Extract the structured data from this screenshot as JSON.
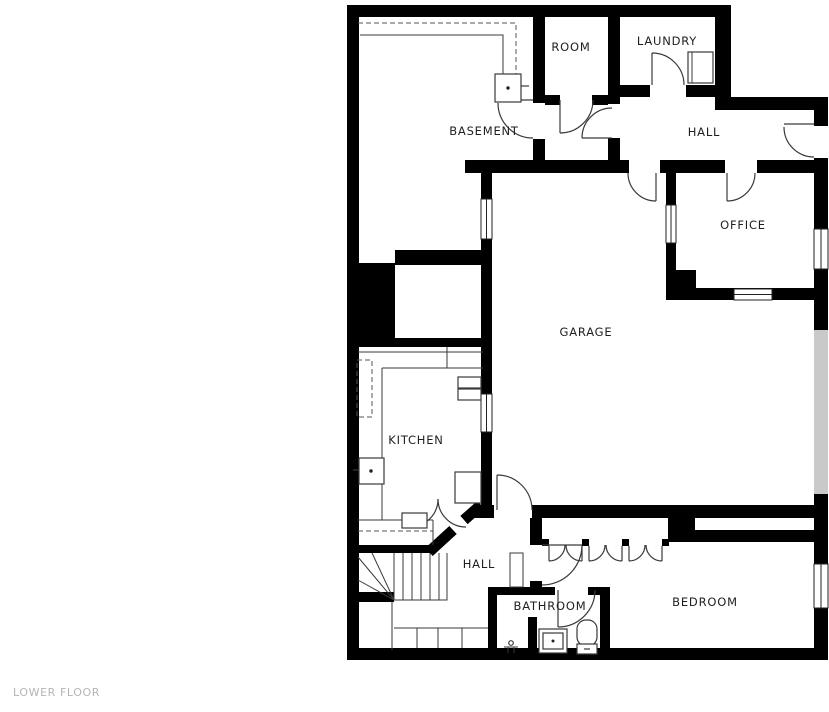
{
  "plan": {
    "floor_label": "LOWER FLOOR",
    "rooms": [
      {
        "id": "basement",
        "label": "BASEMENT",
        "x": 484,
        "y": 135
      },
      {
        "id": "room",
        "label": "ROOM",
        "x": 571,
        "y": 51
      },
      {
        "id": "laundry",
        "label": "LAUNDRY",
        "x": 667,
        "y": 45
      },
      {
        "id": "hall-upper",
        "label": "HALL",
        "x": 704,
        "y": 136
      },
      {
        "id": "office",
        "label": "OFFICE",
        "x": 743,
        "y": 229
      },
      {
        "id": "garage",
        "label": "GARAGE",
        "x": 586,
        "y": 336
      },
      {
        "id": "kitchen",
        "label": "KITCHEN",
        "x": 416,
        "y": 444
      },
      {
        "id": "hall-lower",
        "label": "HALL",
        "x": 479,
        "y": 568
      },
      {
        "id": "bathroom",
        "label": "BATHROOM",
        "x": 550,
        "y": 610
      },
      {
        "id": "bedroom",
        "label": "BEDROOM",
        "x": 705,
        "y": 606
      }
    ],
    "colors": {
      "wall": "#000000",
      "background": "#ffffff",
      "line": "#3a3a3a",
      "garage_door": "#c9c9c9",
      "floor_label": "#b5b5b5"
    }
  }
}
